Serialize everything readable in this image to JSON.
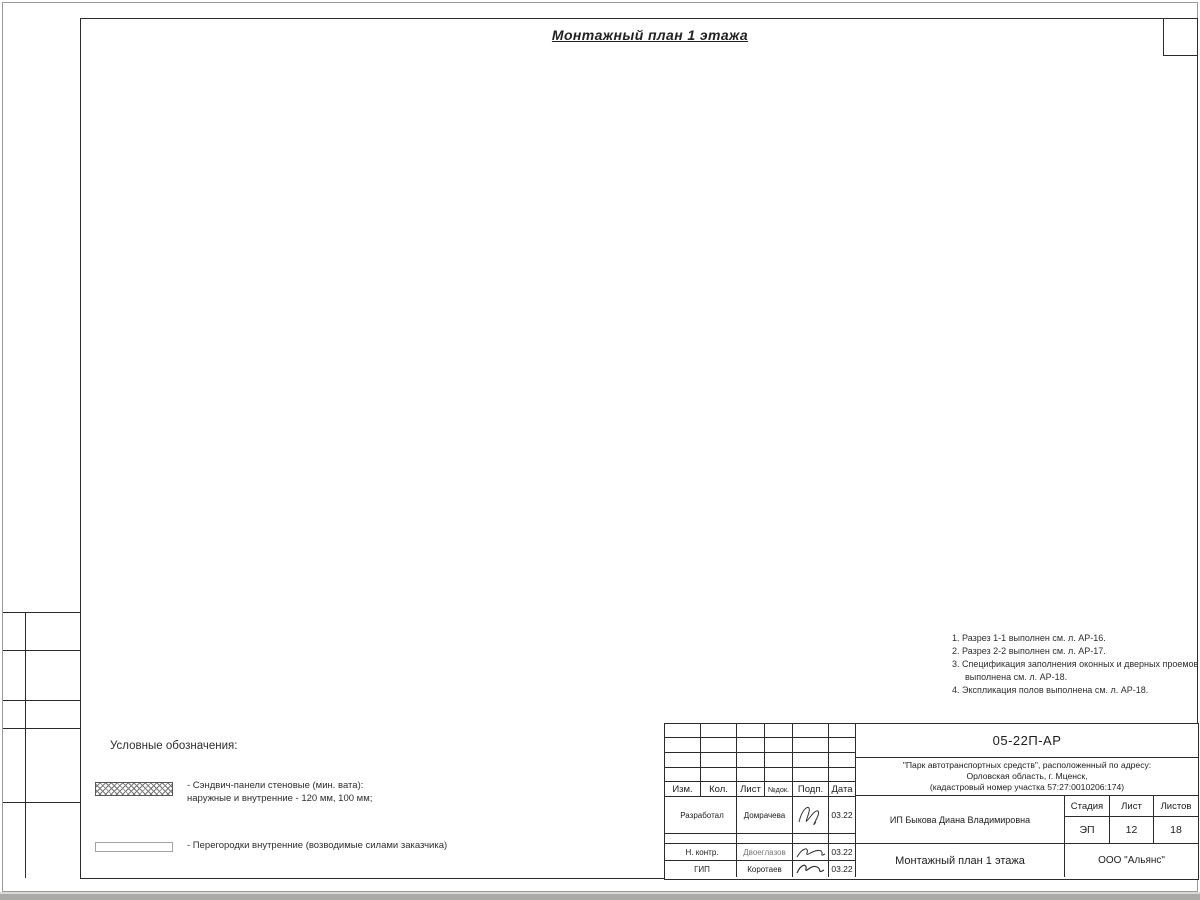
{
  "title": "Монтажный план 1 этажа",
  "notes": [
    "1. Разрез 1-1 выполнен см. л. АР-16.",
    "2. Разрез 2-2 выполнен см. л. АР-17.",
    "3. Спецификация заполнения оконных и дверных проемов выполнена см. л. АР-18.",
    "4. Экспликация полов выполнена см. л. АР-18."
  ],
  "legend": {
    "heading": "Условные обозначения:",
    "items": [
      {
        "symbol": "crosshatch",
        "line1": "- Сэндвич-панели стеновые (мин. вата):",
        "line2": "наружные и внутренние - 120 мм, 100 мм;"
      },
      {
        "symbol": "plain",
        "line1": "- Перегородки внутренние (возводимые силами заказчика)",
        "line2": ""
      }
    ]
  },
  "titleblock": {
    "doc_code": "05-22П-АР",
    "project_lines": [
      "\"Парк автотранспортных средств\",  расположенный по адресу:",
      "Орловская область, г. Мценск,",
      "(кадастровый номер участка 57:27:0010206:174)"
    ],
    "client": "ИП Быкова Диана Владимировна",
    "sheet_title": "Монтажный план 1 этажа",
    "org": "ООО \"Альянс\"",
    "stage_label": "Стадия",
    "sheet_label": "Лист",
    "sheets_label": "Листов",
    "stage": "ЭП",
    "sheet_no": "12",
    "sheets_total": "18",
    "cols": [
      "Изм.",
      "Кол.",
      "Лист",
      "№док.",
      "Подп.",
      "Дата"
    ],
    "rows": [
      {
        "role": "Разработал",
        "name": "Домрачева",
        "date": "03.22"
      },
      {
        "role": "Н. контр.",
        "name": "Двоеглазов",
        "date": "03.22"
      },
      {
        "role": "ГИП",
        "name": "Коротаев",
        "date": "03.22"
      }
    ]
  },
  "plan": {
    "slope_label": "i=0,02",
    "rows": [
      [
        "Ж",
        114
      ],
      [
        "Е",
        194
      ],
      [
        "Д",
        274
      ],
      [
        "Г",
        354
      ],
      [
        "В",
        434
      ],
      [
        "Б",
        514
      ],
      [
        "А",
        594
      ]
    ],
    "cols": [
      [
        "1",
        417
      ],
      [
        "2",
        537
      ],
      [
        "3",
        657
      ],
      [
        "4",
        777
      ],
      [
        "5",
        897
      ]
    ],
    "sections": [
      [
        "1",
        452,
        94
      ],
      [
        "2",
        727,
        96
      ],
      [
        "1",
        449,
        699
      ],
      [
        "2",
        725,
        699
      ]
    ],
    "slopes": [
      [
        566,
        233,
        "r"
      ],
      [
        634,
        233,
        "l"
      ],
      [
        806,
        233,
        "r"
      ],
      [
        874,
        233,
        "l"
      ],
      [
        566,
        473,
        "r"
      ],
      [
        634,
        473,
        "l"
      ],
      [
        806,
        473,
        "r"
      ],
      [
        874,
        473,
        "l"
      ],
      [
        594,
        138,
        "d"
      ],
      [
        834,
        138,
        "d"
      ],
      [
        594,
        563,
        "u"
      ],
      [
        834,
        563,
        "u"
      ]
    ],
    "labels": [
      [
        "4980",
        458,
        75
      ],
      [
        "1000",
        517,
        75
      ],
      [
        "1920",
        546,
        75
      ],
      [
        "2500",
        591,
        75
      ],
      [
        "3500",
        651,
        75
      ],
      [
        "2500",
        711,
        75
      ],
      [
        "2250",
        758,
        75
      ],
      [
        "1200",
        793,
        75
      ],
      [
        "800",
        813,
        75
      ],
      [
        "1000",
        831,
        75
      ],
      [
        "800",
        849,
        75
      ],
      [
        "1200",
        869,
        75
      ],
      [
        "620",
        888,
        75
      ],
      [
        "1700",
        513,
        94
      ],
      [
        "350",
        510,
        104
      ],
      [
        "1200",
        540,
        100,
        1
      ],
      [
        "1600",
        822,
        93
      ],
      [
        "300",
        819,
        104
      ],
      [
        "1200",
        847,
        99,
        1
      ],
      [
        "150",
        391,
        95,
        1
      ],
      [
        "500",
        367,
        104,
        1
      ],
      [
        "1600",
        391,
        131,
        1
      ],
      [
        "300",
        402,
        125,
        1
      ],
      [
        "1200",
        401,
        158
      ],
      [
        "1070",
        381,
        151,
        1
      ],
      [
        "1100",
        381,
        173,
        1
      ],
      [
        "1450",
        381,
        198,
        1
      ],
      [
        "2000",
        381,
        236,
        1
      ],
      [
        "2000",
        381,
        276,
        1
      ],
      [
        "2000",
        381,
        316,
        1
      ],
      [
        "2000",
        381,
        356,
        1
      ],
      [
        "2000",
        381,
        396,
        1
      ],
      [
        "2000",
        381,
        436,
        1
      ],
      [
        "2450",
        381,
        499,
        1
      ],
      [
        "1100",
        377,
        541,
        1
      ],
      [
        "1570",
        381,
        576,
        1
      ],
      [
        "4000",
        352,
        154,
        1
      ],
      [
        "4000",
        352,
        234,
        1
      ],
      [
        "4000",
        352,
        314,
        1
      ],
      [
        "4000",
        352,
        394,
        1
      ],
      [
        "4000",
        352,
        474,
        1
      ],
      [
        "4000",
        352,
        554,
        1
      ],
      [
        "24000",
        336,
        354,
        1
      ],
      [
        "4870",
        921,
        162,
        1
      ],
      [
        "2500",
        921,
        236,
        1
      ],
      [
        "9500",
        921,
        356,
        1
      ],
      [
        "2500",
        921,
        476,
        1
      ],
      [
        "4870",
        921,
        549,
        1
      ],
      [
        "1500",
        912,
        612,
        1
      ],
      [
        "7500",
        928,
        617,
        1
      ],
      [
        "1120",
        419,
        640
      ],
      [
        "4000",
        470,
        640
      ],
      [
        "2000",
        530,
        640
      ],
      [
        "4000",
        590,
        640
      ],
      [
        "2000",
        650,
        640
      ],
      [
        "4000",
        710,
        640
      ],
      [
        "2000",
        770,
        640
      ],
      [
        "4000",
        830,
        640
      ],
      [
        "1120",
        882,
        640
      ],
      [
        "6000",
        477,
        658
      ],
      [
        "6000",
        597,
        658
      ],
      [
        "6000",
        717,
        658
      ],
      [
        "6000",
        837,
        658
      ],
      [
        "24000",
        657,
        676
      ],
      [
        "4600",
        591,
        621
      ],
      [
        "4600",
        711,
        621
      ],
      [
        "4600",
        831,
        621
      ],
      [
        "300",
        557,
        607
      ],
      [
        "300",
        677,
        607
      ],
      [
        "300",
        797,
        607
      ],
      [
        "11935",
        672,
        120
      ],
      [
        "100",
        791,
        123
      ],
      [
        "5775",
        846,
        118
      ],
      [
        "2275",
        806,
        147
      ],
      [
        "2500",
        868,
        149
      ],
      [
        "1000",
        838,
        157
      ],
      [
        "2310",
        565,
        149
      ],
      [
        "2500",
        627,
        142
      ],
      [
        "1000",
        599,
        160
      ],
      [
        "1690",
        519,
        127
      ],
      [
        "2525",
        679,
        212
      ],
      [
        "1000",
        716,
        212
      ],
      [
        "950",
        471,
        124
      ],
      [
        "950",
        494,
        124
      ],
      [
        "100",
        455,
        135
      ],
      [
        "100",
        487,
        135
      ],
      [
        "100",
        511,
        135
      ],
      [
        "1800",
        437,
        136,
        1
      ],
      [
        "4070",
        423,
        169,
        1
      ],
      [
        "2170",
        441,
        189,
        1
      ],
      [
        "200",
        463,
        160
      ],
      [
        "200",
        486,
        160
      ],
      [
        "350",
        466,
        171
      ],
      [
        "125",
        489,
        171
      ],
      [
        "800",
        514,
        186,
        1
      ],
      [
        "2000",
        528,
        147,
        1
      ],
      [
        "2200",
        437,
        205
      ],
      [
        "2000",
        483,
        205
      ],
      [
        "100",
        465,
        221
      ],
      [
        "3900",
        428,
        232,
        1
      ],
      [
        "2700",
        508,
        215,
        1
      ],
      [
        "900",
        508,
        257,
        1
      ],
      [
        "2100",
        508,
        287,
        1
      ],
      [
        "1000",
        507,
        315,
        1
      ],
      [
        "1530",
        506,
        339,
        1
      ],
      [
        "3930",
        428,
        312,
        1
      ],
      [
        "4300",
        460,
        336
      ],
      [
        "100",
        437,
        287
      ],
      [
        "6090",
        474,
        488
      ],
      [
        "7630",
        432,
        434,
        1
      ],
      [
        "9670",
        551,
        285,
        1
      ],
      [
        "9130",
        552,
        478,
        1
      ],
      [
        "4070",
        428,
        549,
        1
      ],
      [
        "1270",
        519,
        583,
        1
      ],
      [
        "1500",
        399,
        521
      ],
      [
        "600",
        406,
        545,
        1
      ],
      [
        "2300",
        393,
        554,
        1
      ],
      [
        "1100",
        375,
        556,
        1
      ],
      [
        "1570",
        379,
        581,
        1
      ],
      [
        "2450",
        379,
        505,
        1
      ],
      [
        "100",
        421,
        521,
        1
      ],
      [
        "7000",
        613,
        237,
        1
      ],
      [
        "7000",
        613,
        477,
        1
      ],
      [
        "7000",
        853,
        237,
        1
      ],
      [
        "7000",
        853,
        477,
        1
      ],
      [
        "2570",
        618,
        563,
        1
      ],
      [
        "2570",
        858,
        563,
        1
      ],
      [
        "20000",
        748,
        430,
        1
      ],
      [
        "6900",
        792,
        520,
        1
      ],
      [
        "2000",
        747,
        577,
        1
      ],
      [
        "100",
        437,
        512,
        1
      ]
    ]
  }
}
